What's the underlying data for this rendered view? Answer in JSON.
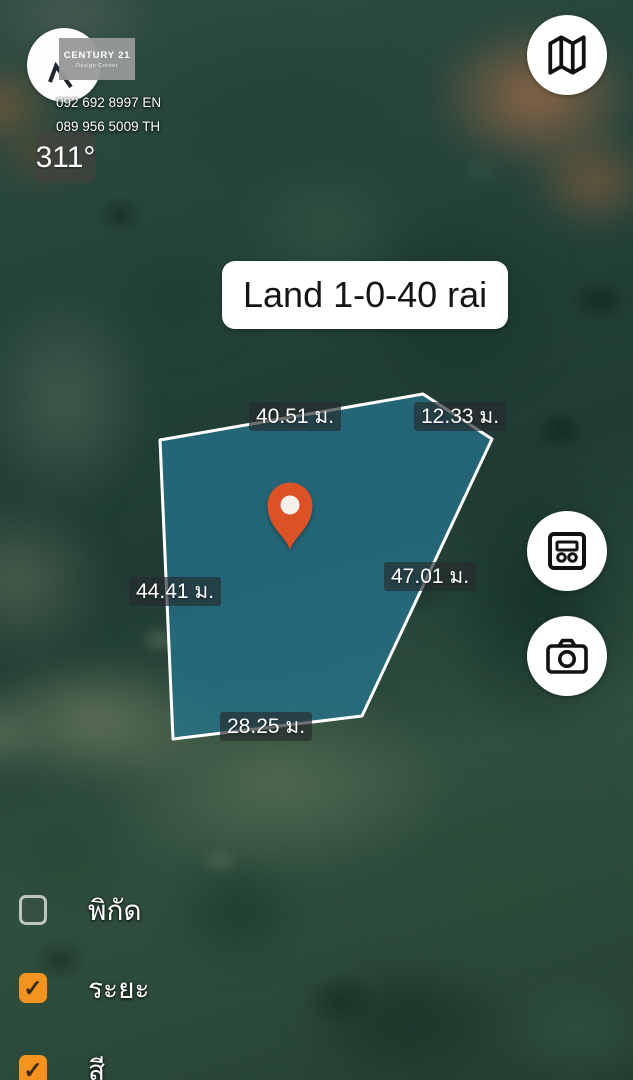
{
  "branding": {
    "logo_title": "CENTURY 21",
    "logo_subtitle": "Design Corner",
    "phone_en": "092 692 8997 EN",
    "phone_th": "089 956 5009 TH"
  },
  "compass": {
    "heading": "311°"
  },
  "land_label": {
    "text": "Land 1-0-40 rai"
  },
  "measurements": {
    "top": "40.51 ม.",
    "top_right": "12.33 ม.",
    "right": "47.01 ม.",
    "left": "44.41 ม.",
    "bottom": "28.25 ม."
  },
  "toggles": [
    {
      "label": "พิกัด",
      "checked": false
    },
    {
      "label": "ระยะ",
      "checked": true
    },
    {
      "label": "สี",
      "checked": true
    }
  ],
  "icons": {
    "check": "✓",
    "map_button": "folded-map",
    "card_button": "detail-card",
    "camera_button": "camera",
    "marker": "location-pin",
    "compass_needle": "northwest-arrow"
  },
  "colors": {
    "accent_orange": "#F4941F",
    "pin_fill": "#DB5227",
    "polygon_fill": "rgba(38,116,142,0.75)",
    "polygon_stroke": "#FFFFFF",
    "label_bg": "rgba(38,42,45,0.66)"
  },
  "polygon": {
    "points": [
      [
        423,
        394
      ],
      [
        492,
        439
      ],
      [
        362,
        716
      ],
      [
        173,
        739
      ],
      [
        160,
        440
      ]
    ]
  }
}
